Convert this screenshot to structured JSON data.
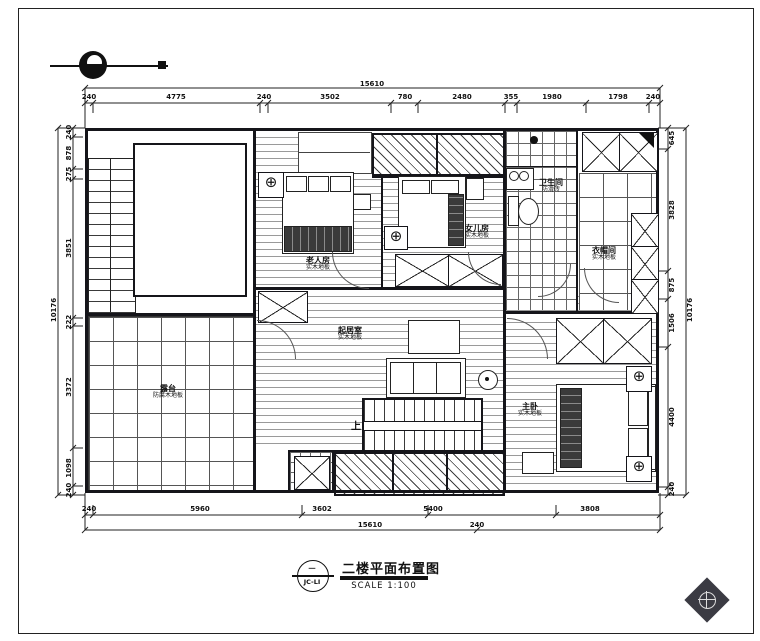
{
  "title_block": {
    "drawing_no_top": "一",
    "drawing_no_bottom": "JC-LI",
    "title": "二楼平面布置图",
    "scale": "SCALE 1:100"
  },
  "rooms": {
    "elder": {
      "name": "老人房",
      "floor": "实木地板"
    },
    "daughter": {
      "name": "女儿房",
      "floor": "实木地板"
    },
    "bath": {
      "name": "卫生间",
      "floor": "防滑砖"
    },
    "cloak": {
      "name": "衣帽间",
      "floor": "实木地板"
    },
    "family": {
      "name": "起居室",
      "floor": "实木地板"
    },
    "master": {
      "name": "主卧",
      "floor": "实木地板"
    },
    "terrace": {
      "name": "露台",
      "floor": "防腐木地板"
    },
    "stair_up_label": "上"
  },
  "dimensions": {
    "top_overall": "15610",
    "top": [
      "240",
      "4775",
      "240",
      "3502",
      "780",
      "2480",
      "355",
      "1980",
      "1798",
      "240"
    ],
    "bottom": [
      "240",
      "5960",
      "3602",
      "5400",
      "3808"
    ],
    "bottom_overall": "15610",
    "bottom_end": "240",
    "left": [
      "240",
      "878",
      "275",
      "3851",
      "222",
      "3372",
      "1098",
      "240"
    ],
    "left_overall": "10176",
    "right": [
      "645",
      "3828",
      "875",
      "1506",
      "4400",
      "240"
    ],
    "right_overall": "10176"
  },
  "colors": {
    "line": "#15151a",
    "paper": "#ffffff",
    "logo": "#3b3b43"
  }
}
